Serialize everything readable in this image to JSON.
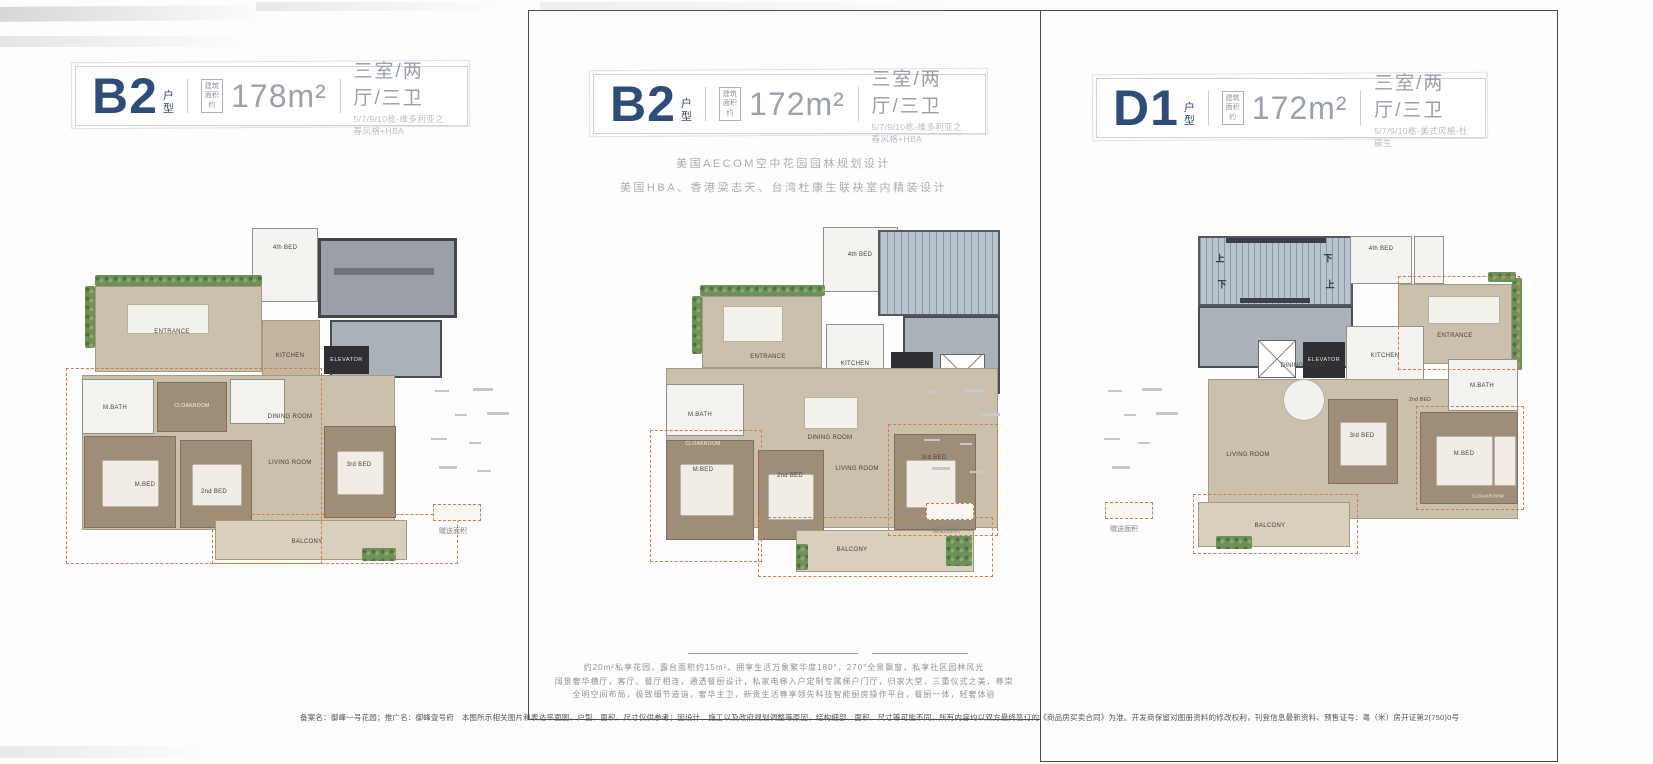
{
  "shared": {
    "suffix_top": "户",
    "suffix_bottom": "型",
    "area_l1": "建筑",
    "area_l2": "面积约",
    "gift_label": "赠送面积"
  },
  "panels": [
    {
      "unit": "B2",
      "area": "178m²",
      "config": "三室/两厅/三卫",
      "subtitle": "5/7/9/10栋-维多利亚之春风格+HBA",
      "rooms": {
        "entrance": "ENTRANCE",
        "kitchen": "KITCHEN",
        "elevator": "ELEVATOR",
        "dining": "DINING ROOM",
        "living": "LIVING ROOM",
        "m_bed": "M.BED",
        "m_bath": "M.BATH",
        "bed2": "2nd BED",
        "bed3": "3rd BED",
        "bed4": "4th BED",
        "balcony": "BALCONY",
        "cloakroom": "CLOAKROOM"
      }
    },
    {
      "unit": "B2",
      "area": "172m²",
      "config": "三室/两厅/三卫",
      "subtitle": "5/7/9/10栋-维多利亚之春风格+HBA",
      "notes": [
        "美国AECOM空中花园园林规划设计",
        "美国HBA、香港梁志天、台湾杜康生联袂室内精装设计"
      ],
      "features": [
        "约20m²私享花园，露台面积约15m²，拥享生活万象繁华度180°，270°全景飘窗，私享社区园林风光",
        "阔景奢华横厅，客厅、餐厅相连，通透餐厨设计，私家电梯入户定制专属梯户门厅，归家大堂，三重仪式之美，尊崇",
        "全明空间布局，极致细节造诣，奢华主卫，新贵生活尊享领先科技智能厨房操作平台，餐厨一体，轻奢体验"
      ],
      "rooms": {
        "entrance": "ENTRANCE",
        "kitchen": "KITCHEN",
        "elevator": "ELEVATOR",
        "dining": "DINING ROOM",
        "living": "LIVING ROOM",
        "m_bed": "M.BED",
        "m_bath": "M.BATH",
        "bed2": "2nd BED",
        "bed3": "3rd BED",
        "bed4": "4th BED",
        "balcony": "BALCONY",
        "cloakroom": "CLOAKROOM"
      }
    },
    {
      "unit": "D1",
      "area": "172m²",
      "config": "三室/两厅/三卫",
      "subtitle": "5/7/9/10栋-美式风格-杜康生",
      "stairs": {
        "up": "上",
        "down": "下"
      },
      "rooms": {
        "entrance": "ENTRANCE",
        "kitchen": "KITCHEN",
        "elevator": "ELEVATOR",
        "dining": "DINING ROOM",
        "living": "LIVING ROOM",
        "m_bed": "M.BED",
        "m_bath": "M.BATH",
        "bed2": "2nd BED",
        "bed3": "3rd BED",
        "bed4": "4th BED",
        "balcony": "BALCONY",
        "cloakroom": "CLOAKROOM"
      }
    }
  ],
  "disclaimer": "备案名：御峰一号花园；推广名：御峰壹号府　本图所示相关图片和表达平面图，户型、面积、尺寸仅供参考；因设计、施工以及政府规划调整等原因，结构细部、面积、尺寸等可能不同，所有内容均以双方最终签订的《商品房买卖合同》为准。开发商保留对图册资料的修改权利，刊登信息最新资料、预售证号：粤（米）房开证第2(750)0号",
  "colors": {
    "unit_navy": "#2e4d78",
    "muted_gray": "#9aa2ac",
    "floor_tan": "#cbc0ab",
    "wood": "#9f8e77",
    "roof_gray": "#9aa0a6",
    "stair_blue": "#b9c5ce",
    "plants_green": "#6f9159",
    "gift_dash_orange": "#d07f4c",
    "elevator_dark": "#2e2f33"
  }
}
